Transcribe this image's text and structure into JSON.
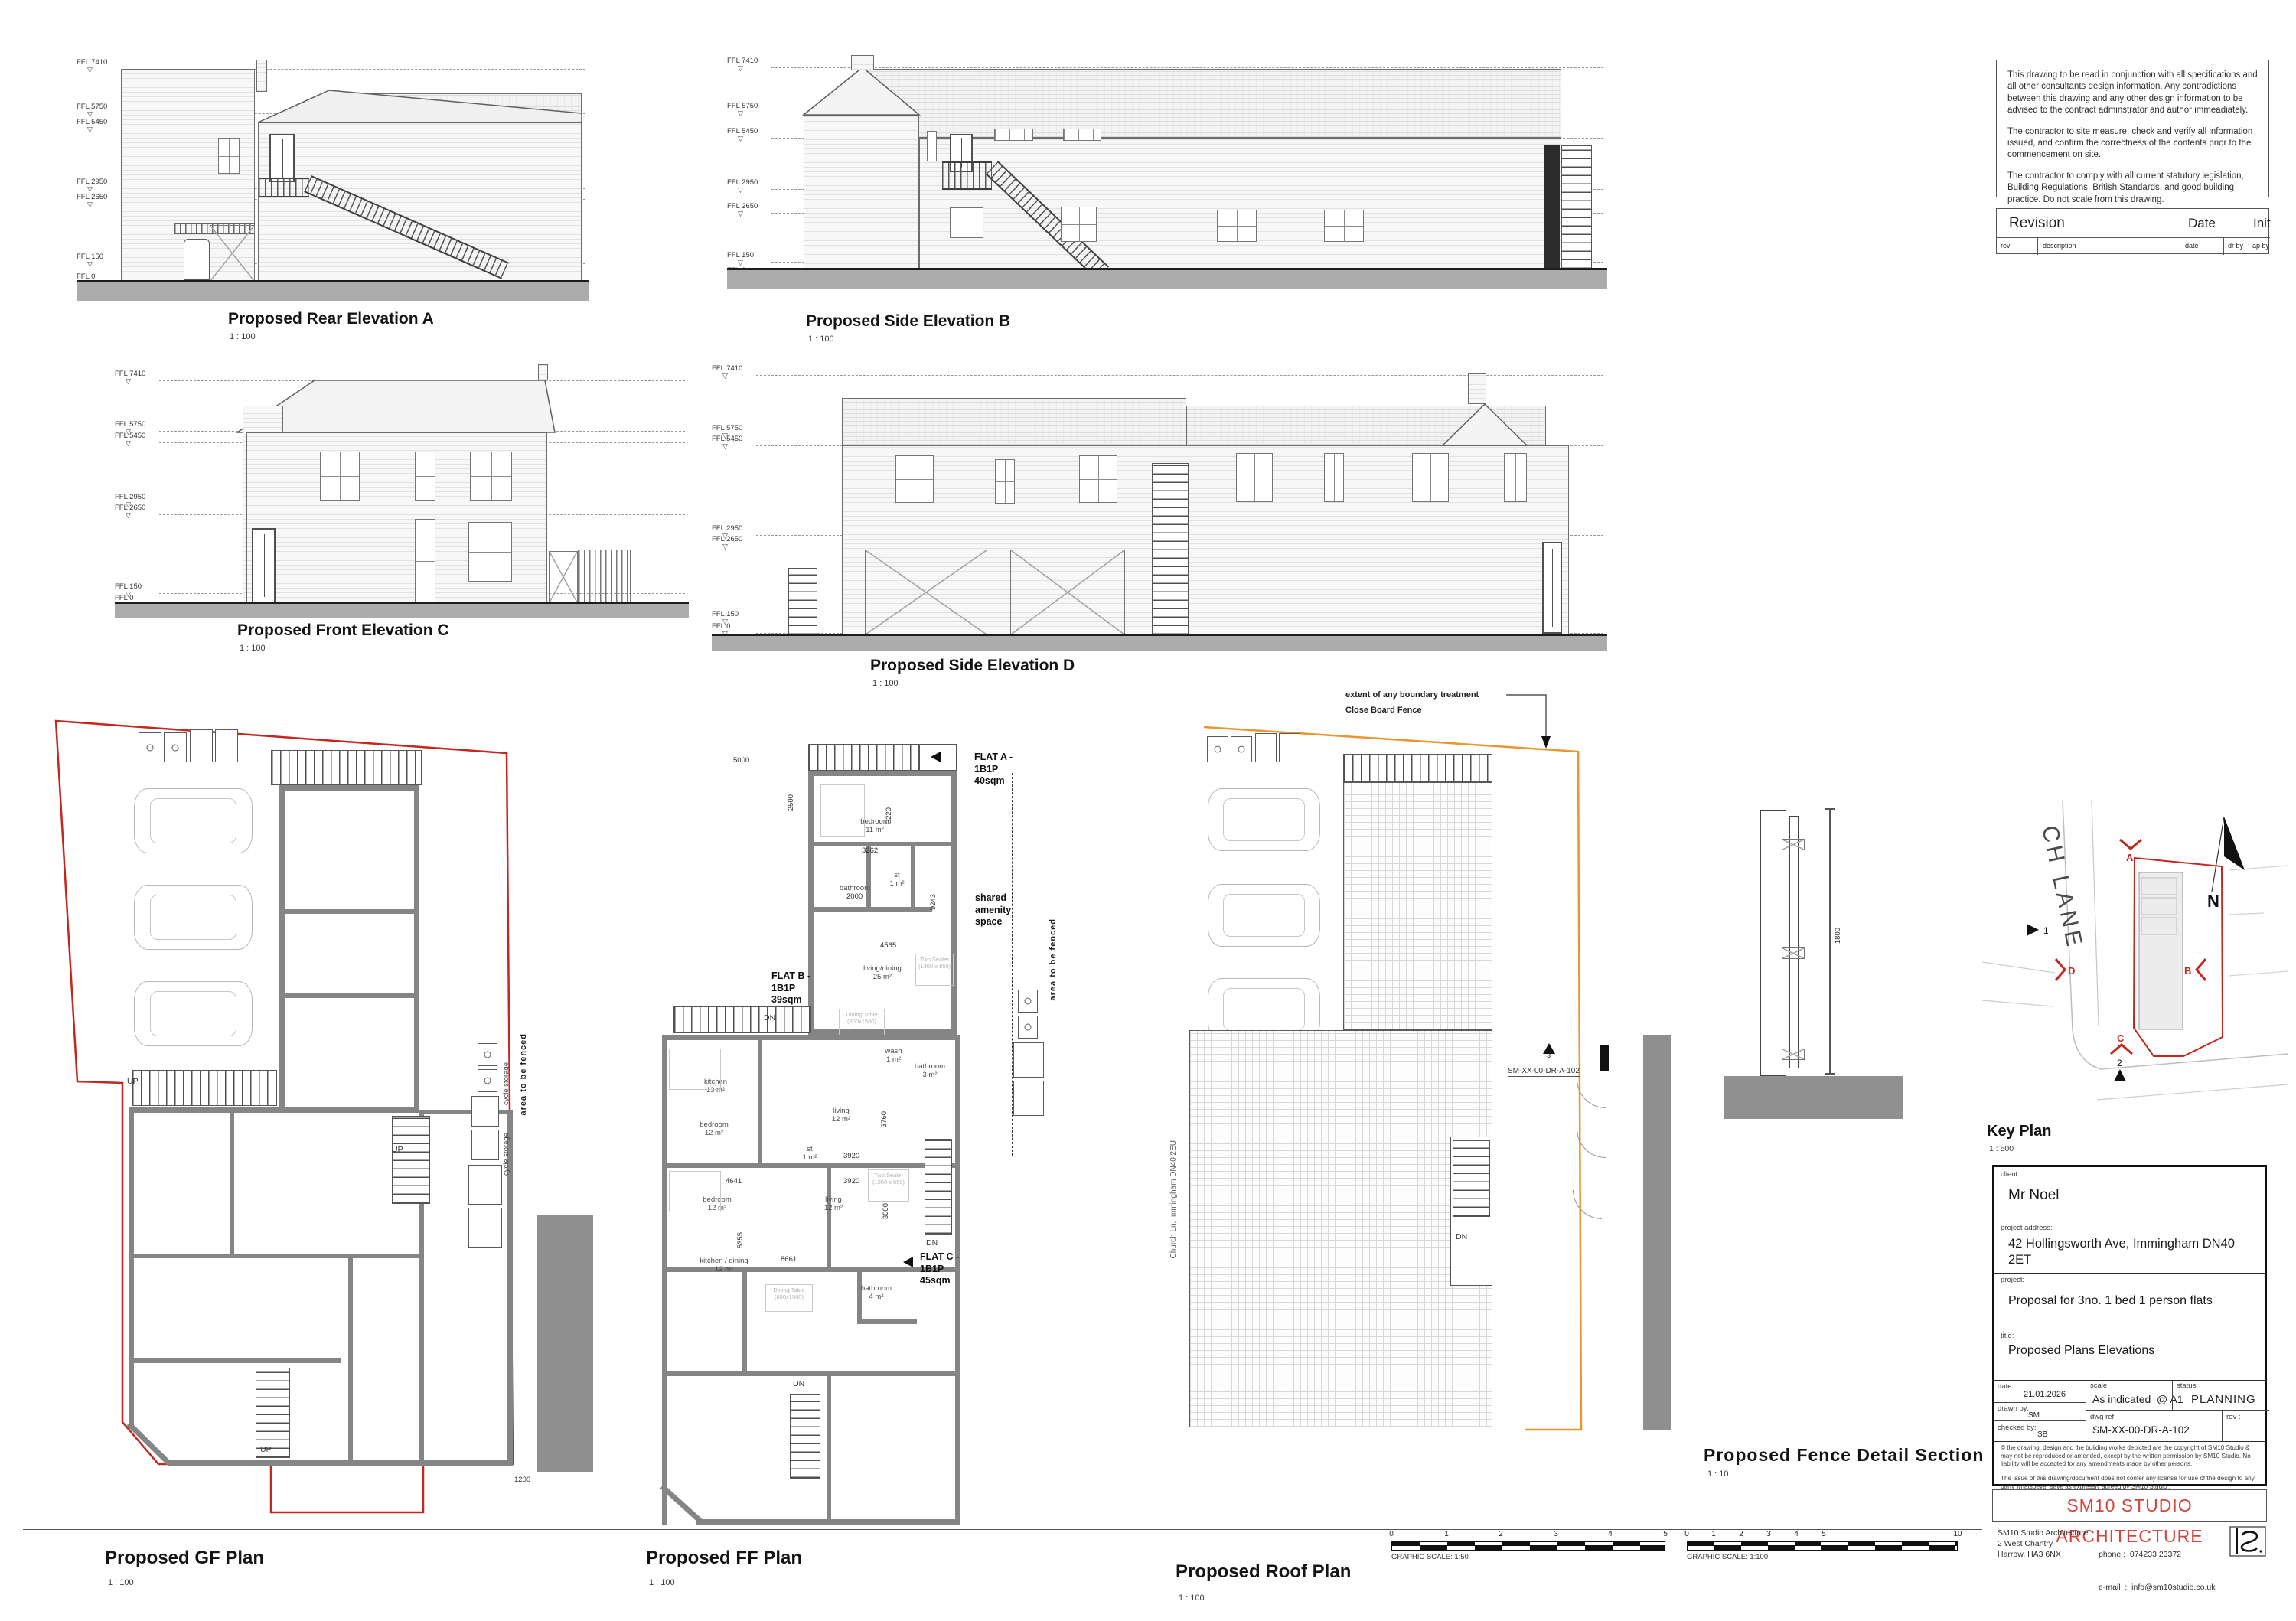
{
  "colors": {
    "boundary_red": "#c3271d",
    "fence_orange": "#e8962e",
    "brand_red": "#d6453d",
    "ground_gray": "#acacac"
  },
  "labels": {
    "up": "UP",
    "dn": "DN",
    "level_marker": "▽",
    "ffl": [
      "FFL  7410",
      "FFL  5750",
      "FFL  5450",
      "FFL  2950",
      "FFL  2650",
      "FFL  150",
      "FFL  0"
    ]
  },
  "views": {
    "rear_a": {
      "title": "Proposed Rear Elevation A",
      "scale": "1 : 100"
    },
    "side_b": {
      "title": "Proposed Side Elevation B",
      "scale": "1 : 100"
    },
    "front_c": {
      "title": "Proposed Front Elevation C",
      "scale": "1 : 100"
    },
    "side_d": {
      "title": "Proposed Side Elevation D",
      "scale": "1 : 100"
    },
    "gf": {
      "title": "Proposed GF Plan",
      "scale": "1 : 100"
    },
    "ff": {
      "title": "Proposed FF Plan",
      "scale": "1 : 100"
    },
    "roof": {
      "title": "Proposed Roof Plan",
      "scale": "1 : 100"
    },
    "fence": {
      "title": "Proposed Fence Detail Section",
      "scale": "1 : 10"
    },
    "key": {
      "title": "Key Plan",
      "scale": "1 : 500"
    }
  },
  "notes": {
    "p1": "This drawing to be read in conjunction with all specifications and all other consultants design information. Any contradictions between this drawing and any other design information to be advised to the contract adminstrator and author immeadiately.",
    "p2": "The contractor to site measure, check and verify all information issued, and confirm the correctness of the contents prior to the commencement on site.",
    "p3": "The contractor to comply with all current statutory legislation, Building Regulations, British Standards, and good building practice. Do not scale from this drawing."
  },
  "revision": {
    "title": "Revision",
    "date": "Date",
    "init": "Init",
    "rev": "rev",
    "description": "description",
    "date_small": "date",
    "dr_by": "dr by",
    "ap_by": "ap by"
  },
  "titleblock": {
    "client_label": "client:",
    "client": "Mr Noel",
    "address_label": "project address:",
    "address": "42 Hollingsworth Ave, Immingham DN40 2ET",
    "project_label": "project:",
    "project": "Proposal for 3no. 1 bed 1 person flats",
    "title_label": "title:",
    "title": "Proposed Plans Elevations",
    "date_label": "date:",
    "date": "21.01.2026",
    "drawn_label": "drawn by:",
    "drawn": "SM",
    "checked_label": "checked by:",
    "checked": "SB",
    "scale_label": "scale:",
    "scale": "As indicated  @ A1",
    "status_label": "status:",
    "status": "PLANNING",
    "dwg_label": "dwg ref:",
    "dwg": "SM-XX-00-DR-A-102",
    "rev_label": "rev :",
    "copyright": "©  the drawing, design and the building works depicted are the copyright of SM10 Studio & may not be reproduced or amended, except by the written permission by SM10 Studio. No liability will be accepted for any amendments made by other persons.",
    "issue": "The issue of this drawing/document does not confer any license for use of the design to any party whatsoever save as expressly agreed by SM10 Studio .",
    "brand": "SM10 STUDIO ARCHITECTURE",
    "studio_name": "SM10 Studio Architecture",
    "studio_addr1": "2 West Chantry",
    "studio_addr2": "Harrow, HA3 6NX",
    "phone": "phone :  074233 23372",
    "email": "e-mail  :  info@sm10studio.co.uk"
  },
  "gf": {
    "cycle": "cycle storage",
    "fence_area": "area to be fenced",
    "dim_1200": "1200"
  },
  "ff": {
    "flat_a": "FLAT A -\n1B1P\n40sqm",
    "flat_b": "FLAT B -\n1B1P\n39sqm",
    "flat_c": "FLAT C -\n1B1P\n45sqm",
    "shared": "shared\namenity\nspace",
    "fence_area": "area to be fenced",
    "rooms": [
      "bedroom\n11 m²",
      "bathroom",
      "st\n1 m²",
      "living/dining\n25 m²",
      "kitchen\n13 m²",
      "wash\n1 m²",
      "bathroom\n3 m²",
      "bedroom\n12 m²",
      "st\n1 m²",
      "living\n12 m²",
      "bedroom\n12 m²",
      "living\n12 m²",
      "kitchen / dining\n12 m²",
      "bathroom\n4 m²"
    ],
    "furn_dining": "Dining Table\n(800x1500)",
    "furn_sofa": "Two Seater\n(1300 x 850)",
    "dims": [
      "5000",
      "2500",
      "3220",
      "3262",
      "2000",
      "4565",
      "9243",
      "3760",
      "3920",
      "4641",
      "3920",
      "3000",
      "5355",
      "8661"
    ]
  },
  "roof": {
    "extent_line1": "extent of any boundary treatment",
    "extent_line2": "Close Board Fence",
    "section_ref": "SM-XX-00-DR-A-102",
    "marker": "3",
    "street": "Church Ln, Immingham DN40 2EU"
  },
  "fence_detail": {
    "dim": "1800"
  },
  "key": {
    "street": "CH LANE",
    "north": "N",
    "m_a": "A",
    "m_b": "B",
    "m_c": "C",
    "m_d": "D",
    "m_1": "1",
    "m_2": "2"
  },
  "scales": [
    {
      "label": "GRAPHIC SCALE: 1:50",
      "ticks": [
        "0",
        "1",
        "2",
        "3",
        "4",
        "5"
      ]
    },
    {
      "label": "GRAPHIC SCALE: 1:100",
      "ticks": [
        "0",
        "1",
        "2",
        "3",
        "4",
        "5",
        "10"
      ]
    }
  ]
}
